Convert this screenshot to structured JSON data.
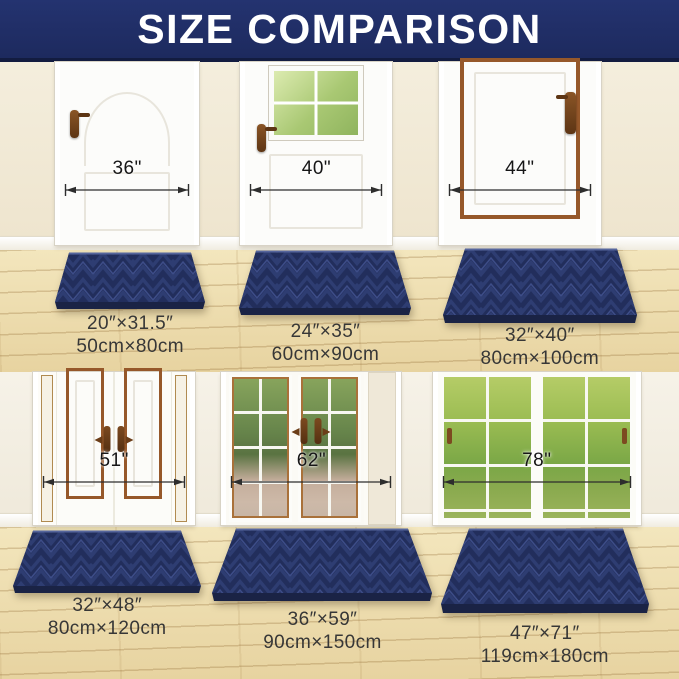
{
  "header": {
    "title": "SIZE COMPARISON"
  },
  "colors": {
    "header_bg": "#1d2a5e",
    "mat_navy": "#2e3d72",
    "floor_wood": "#eedcab",
    "wall_cream": "#f1ead6",
    "door_trim_brown": "#96582a"
  },
  "cells": [
    {
      "door_width": "36\"",
      "mat_inches": "20″×31.5″",
      "mat_cm": "50cm×80cm"
    },
    {
      "door_width": "40\"",
      "mat_inches": "24″×35″",
      "mat_cm": "60cm×90cm"
    },
    {
      "door_width": "44\"",
      "mat_inches": "32″×40″",
      "mat_cm": "80cm×100cm"
    },
    {
      "door_width": "51\"",
      "mat_inches": "32″×48″",
      "mat_cm": "80cm×120cm"
    },
    {
      "door_width": "62\"",
      "mat_inches": "36″×59″",
      "mat_cm": "90cm×150cm"
    },
    {
      "door_width": "78\"",
      "mat_inches": "47″×71″",
      "mat_cm": "119cm×180cm"
    }
  ]
}
